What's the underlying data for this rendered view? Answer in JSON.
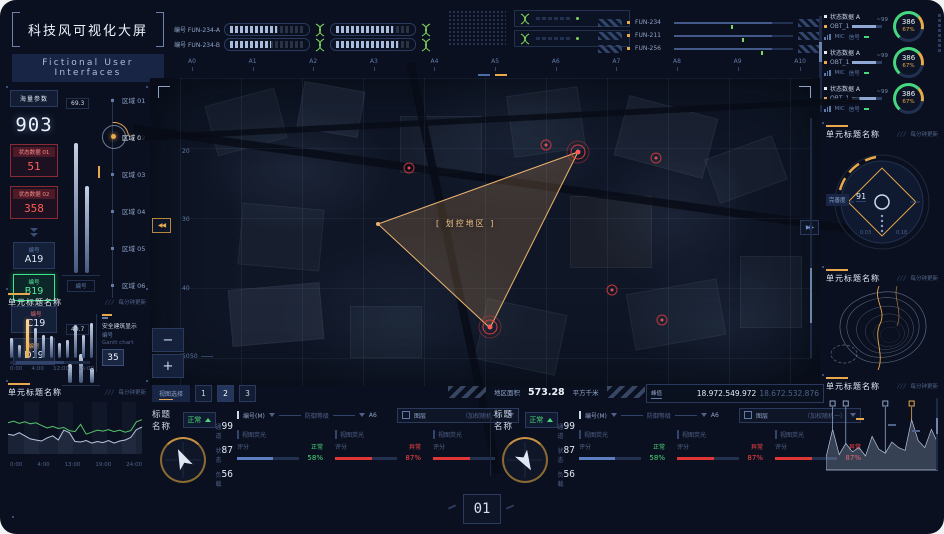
{
  "title": {
    "main": "科技风可视化大屏",
    "sub": "Fictional User Interfaces"
  },
  "top": {
    "gauges": [
      {
        "label": "编号 FUN-234-A"
      },
      {
        "label": "编号 FUN-234-B"
      }
    ],
    "sliders": [
      {
        "label": "FUN-234",
        "value": 48
      },
      {
        "label": "FUN-211",
        "value": 57
      },
      {
        "label": "FUN-256",
        "value": 73
      }
    ]
  },
  "status_panel": {
    "items": [
      {
        "title": "状态数据 A",
        "name": "OBT_1",
        "peak": "~99",
        "mic": "MIC",
        "signal": "信号",
        "value": "386",
        "pct": "67%"
      },
      {
        "title": "状态数据 A",
        "name": "OBT_1",
        "peak": "~99",
        "mic": "MIC",
        "signal": "信号",
        "value": "386",
        "pct": "67%"
      },
      {
        "title": "状态数据 A",
        "name": "OBT_1",
        "peak": "~99",
        "mic": "MIC",
        "signal": "信号",
        "value": "386",
        "pct": "67%"
      }
    ]
  },
  "left": {
    "params": {
      "header": "海量参数",
      "big": "903",
      "alerts": [
        {
          "label": "状态数据 01",
          "value": "51"
        },
        {
          "label": "状态数据 02",
          "value": "358"
        }
      ],
      "chips": [
        {
          "tag": "编号",
          "value": "A19"
        },
        {
          "tag": "编号",
          "value": "B19"
        },
        {
          "tag": "编号",
          "value": "C19"
        },
        {
          "tag": "编号",
          "value": "D19"
        }
      ]
    },
    "meters": [
      {
        "value": "69.3",
        "label": "编号",
        "bars": [
          82,
          55
        ]
      },
      {
        "value": "49.7",
        "label": "编号",
        "bars": [
          45,
          70,
          35
        ]
      }
    ],
    "regions": [
      {
        "label": "区域 01"
      },
      {
        "label": "区域 02"
      },
      {
        "label": "区域 03"
      },
      {
        "label": "区域 04"
      },
      {
        "label": "区域 05"
      },
      {
        "label": "区域 06"
      }
    ],
    "panel_bar": {
      "title": "单元标题名称",
      "update": "每分钟更新",
      "values": [
        46,
        30,
        88,
        68,
        52,
        50,
        34,
        42,
        74,
        52,
        80
      ],
      "highlight": 2,
      "x_labels": [
        "0:00",
        "4:00",
        "12:00",
        "15:00"
      ],
      "card": {
        "line1": "安全建筑显示",
        "line2": "编号",
        "line3": "Gantt chart",
        "value": "35"
      }
    },
    "panel_line": {
      "title": "单元标题名称",
      "update": "每分钟更新",
      "x_labels": [
        "0:00",
        "4:00",
        "13:00",
        "19:00",
        "24:00"
      ],
      "green": [
        60,
        63,
        59,
        62,
        58,
        60,
        55,
        50,
        53,
        49,
        51,
        45,
        43,
        57,
        38,
        42,
        46,
        44,
        47,
        43,
        46,
        42,
        45,
        62,
        66
      ],
      "white": [
        38,
        36,
        41,
        35,
        29,
        27,
        25,
        31,
        35,
        27,
        46,
        41,
        24,
        23,
        26,
        21,
        24,
        22,
        26,
        21,
        25,
        27,
        32,
        47,
        52
      ]
    }
  },
  "map": {
    "cols": [
      "A0",
      "A1",
      "A2",
      "A3",
      "A4",
      "A5",
      "A6",
      "A7",
      "A8",
      "A9",
      "A10"
    ],
    "rows": [
      "20",
      "30",
      "40",
      "50"
    ],
    "zone_label": "[ 划控地区 ]",
    "area": {
      "label": "地区面积",
      "value": "573.28",
      "unit": "平方千米"
    },
    "peak": {
      "label": "峰值",
      "value": "18.972.549.972",
      "value2": "18.672.532.876"
    },
    "view": {
      "label": "视图选择",
      "buttons": [
        "1",
        "2",
        "3"
      ]
    },
    "scale_label": "50",
    "zoom_out": "−",
    "zoom_in": "+"
  },
  "panels": [
    {
      "title": "标题名称",
      "status": "正常",
      "stats": [
        {
          "label": "通道",
          "value": "99"
        },
        {
          "label": "状态",
          "value": "87"
        },
        {
          "label": "负载",
          "value": "56"
        }
      ],
      "route": {
        "from": "编号(M)",
        "mid": "防御等级",
        "to": "A6"
      },
      "layer": {
        "label": "图层",
        "option": "（加权随机一）"
      },
      "metrics": [
        {
          "name": "视图荧光",
          "sub": "评分",
          "status": "正常",
          "pct": "58%",
          "state": "ok",
          "fill": 58
        },
        {
          "name": "视图荧光",
          "sub": "评分",
          "status": "异常",
          "pct": "87%",
          "state": "bad",
          "fill": 60
        },
        {
          "name": "视图荧光",
          "sub": "评分",
          "status": "异常",
          "pct": "87%",
          "state": "bad",
          "fill": 60
        }
      ]
    },
    {
      "title": "标题名称",
      "status": "正常",
      "stats": [
        {
          "label": "通道",
          "value": "99"
        },
        {
          "label": "状态",
          "value": "87"
        },
        {
          "label": "负载",
          "value": "56"
        }
      ],
      "route": {
        "from": "编号(M)",
        "mid": "防御等级",
        "to": "A6"
      },
      "layer": {
        "label": "图层",
        "option": "（加权随机一）"
      },
      "metrics": [
        {
          "name": "视图荧光",
          "sub": "评分",
          "status": "正常",
          "pct": "58%",
          "state": "ok",
          "fill": 58
        },
        {
          "name": "视图荧光",
          "sub": "评分",
          "status": "异常",
          "pct": "87%",
          "state": "bad",
          "fill": 60
        },
        {
          "name": "视图荧光",
          "sub": "评分",
          "status": "异常",
          "pct": "87%",
          "state": "bad",
          "fill": 60
        }
      ]
    }
  ],
  "right": {
    "gauge": {
      "title": "单元标题名称",
      "update": "每分钟更新",
      "value": "91",
      "tag": "完善度"
    },
    "contour": {
      "title": "单元标题名称",
      "update": "每分钟更新"
    },
    "area": {
      "title": "单元标题名称",
      "update": "每分钟更新",
      "values": [
        18,
        58,
        22,
        38,
        26,
        32,
        20,
        48,
        30,
        24,
        40,
        32,
        28,
        72,
        42,
        32,
        58,
        38
      ],
      "markers": [
        {
          "i": 1,
          "c": "blue"
        },
        {
          "i": 3,
          "c": "blue"
        },
        {
          "i": 9,
          "c": "blue"
        },
        {
          "i": 13,
          "c": "orange"
        }
      ]
    }
  },
  "footer": {
    "page": "01"
  }
}
